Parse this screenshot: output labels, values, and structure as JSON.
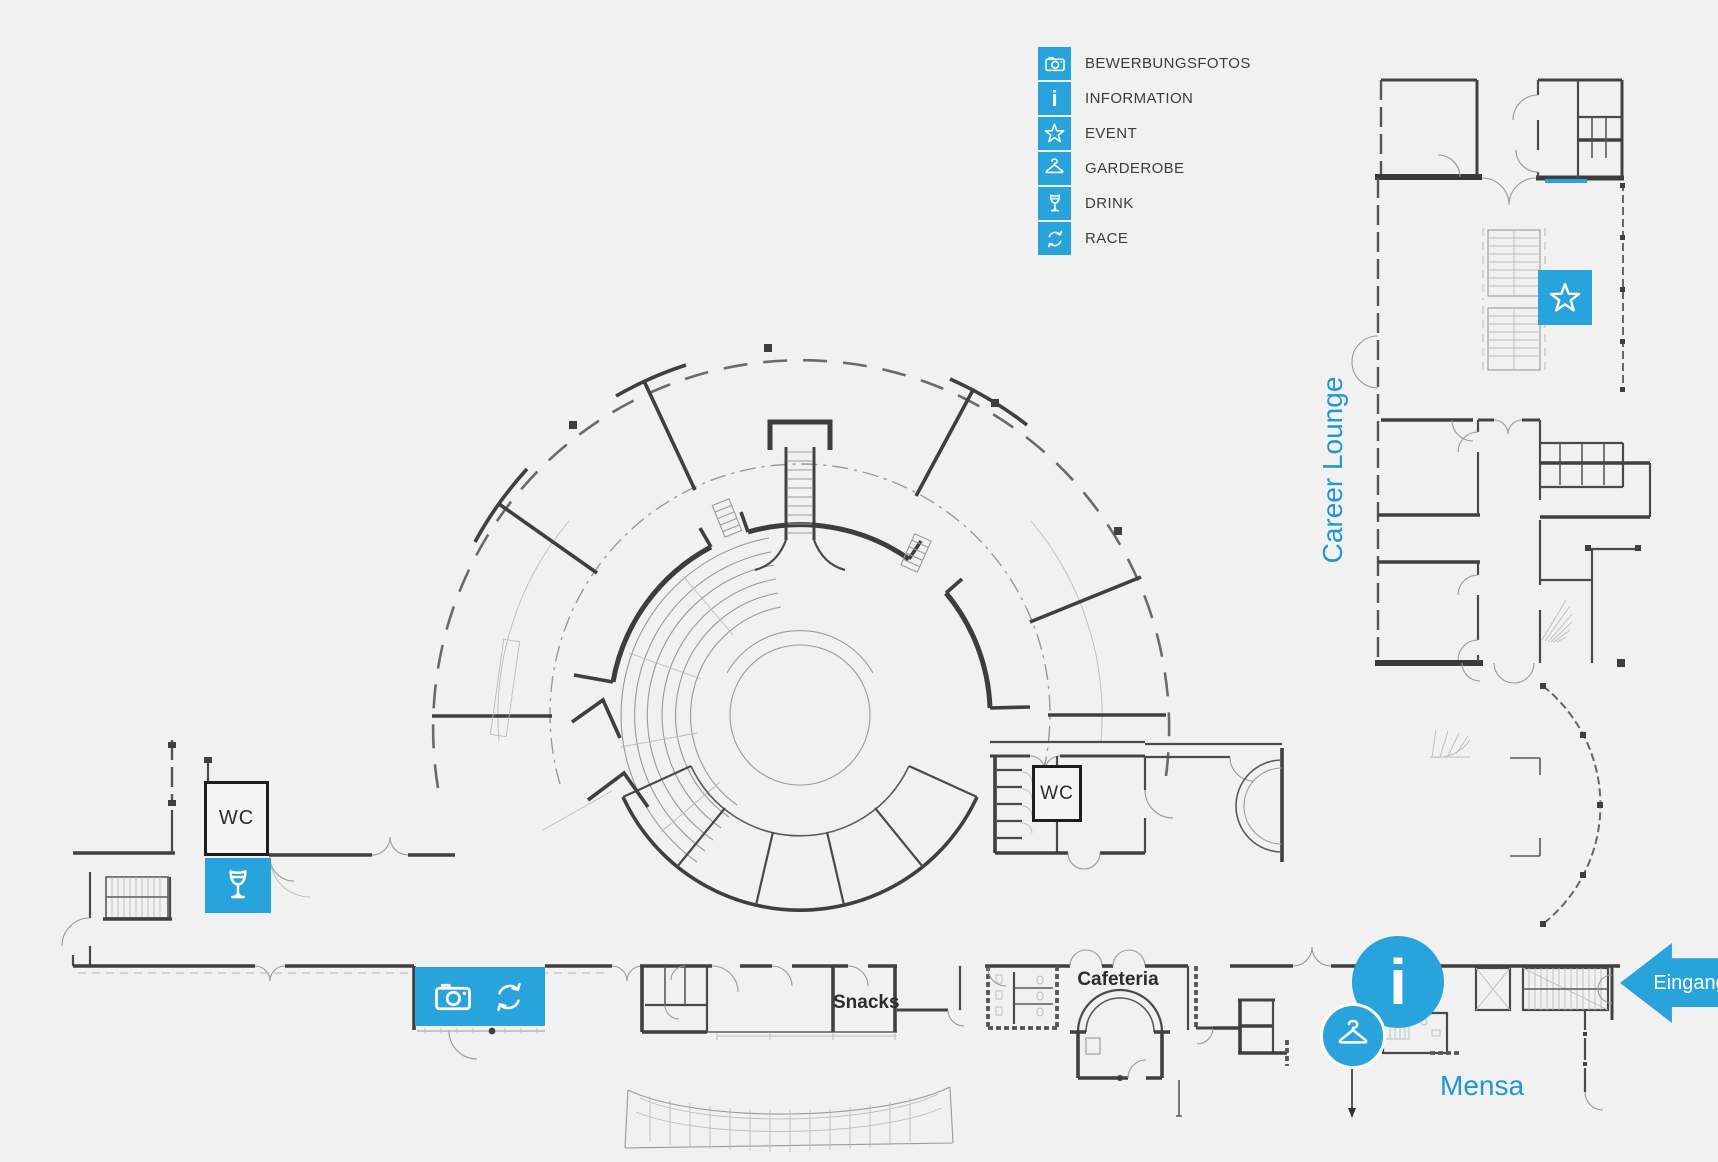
{
  "colors": {
    "accent": "#29A3DC",
    "wall_dark": "#3F3F3F",
    "label_dark": "#3C3C3C",
    "background": "#F1F1F1"
  },
  "legend": {
    "items": [
      {
        "icon": "camera-icon",
        "label": "BEWERBUNGSFOTOS"
      },
      {
        "icon": "information-icon",
        "label": "INFORMATION"
      },
      {
        "icon": "event-star-icon",
        "label": "EVENT"
      },
      {
        "icon": "coat-hanger-icon",
        "label": "GARDEROBE"
      },
      {
        "icon": "drink-glass-icon",
        "label": "DRINK"
      },
      {
        "icon": "race-arrows-icon",
        "label": "RACE"
      }
    ]
  },
  "map": {
    "rooms": {
      "career_lounge": "Career Lounge",
      "mensa": "Mensa",
      "cafeteria": "Cafeteria",
      "snacks": "Snacks",
      "wc_left": "WC",
      "wc_right": "WC"
    },
    "entrance": {
      "label": "Eingang"
    },
    "info_symbol": "i"
  }
}
